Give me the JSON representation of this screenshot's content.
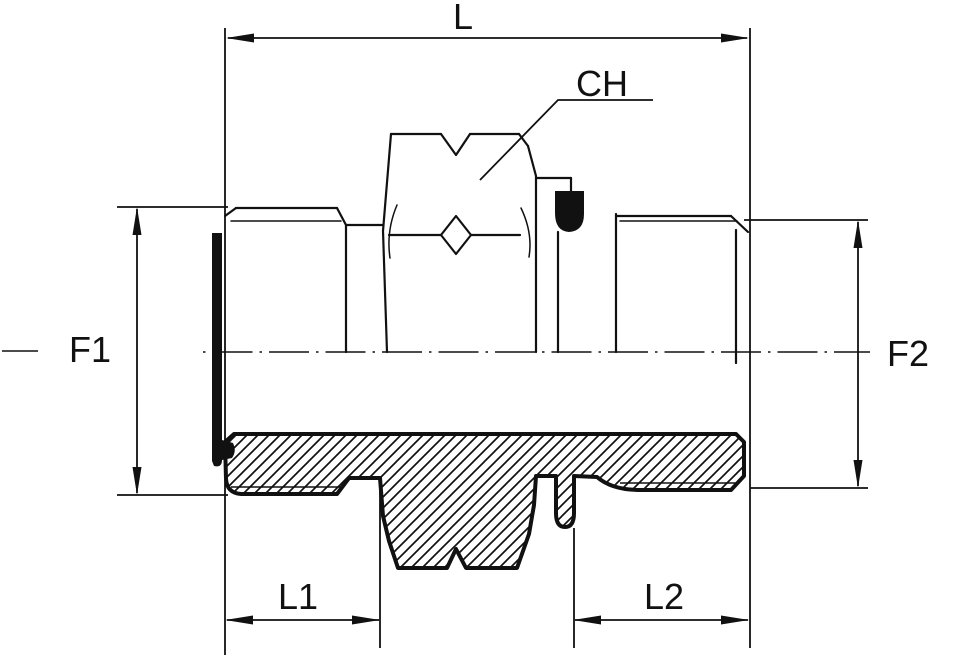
{
  "drawing": {
    "kind": "technical-drawing-half-section",
    "subject": "male-stud-adapter-fitting",
    "colors": {
      "line": "#111111",
      "background": "#ffffff",
      "hatch": "#111111",
      "seal_fill": "#111111"
    },
    "dim_labels": {
      "L": "L",
      "CH": "CH",
      "F1": "F1",
      "F2": "F2",
      "L1": "L1",
      "L2": "L2"
    }
  }
}
